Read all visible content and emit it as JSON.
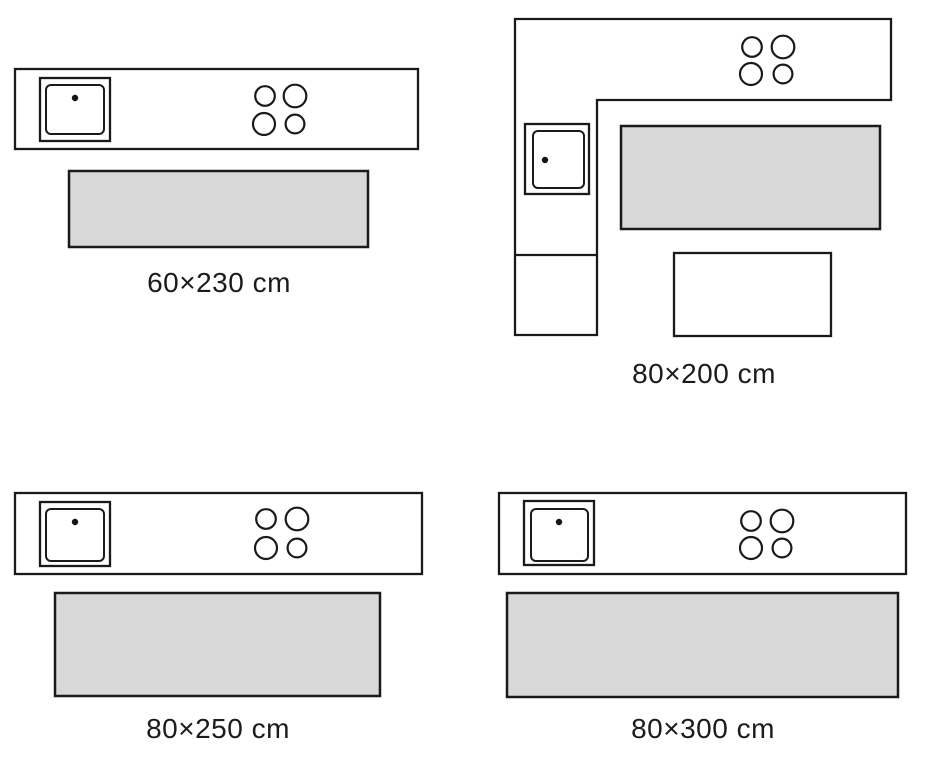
{
  "colors": {
    "line": "#1a1a1a",
    "rug_fill": "#d8d8d8",
    "background": "#ffffff",
    "label_text": "#1b1b1b"
  },
  "diagrams": [
    {
      "label": "60×230 cm"
    },
    {
      "label": "80×200 cm"
    },
    {
      "label": "80×250 cm"
    },
    {
      "label": "80×300 cm"
    }
  ]
}
